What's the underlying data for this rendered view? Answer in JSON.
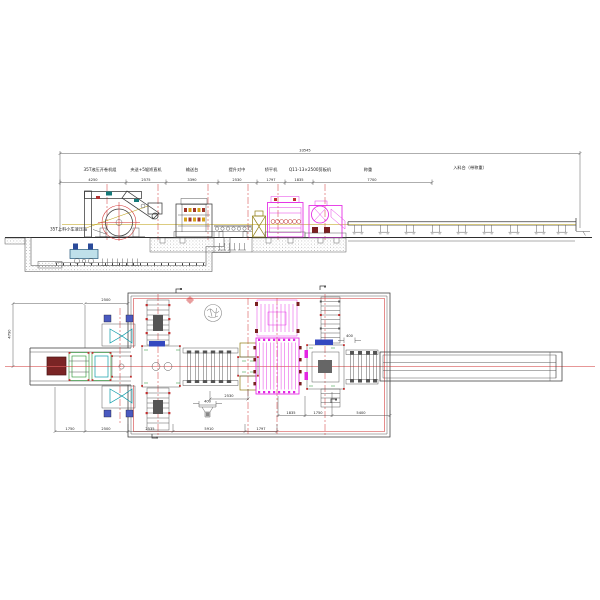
{
  "drawing": {
    "colors": {
      "line": "#3a3a3a",
      "centerline": "#d03030",
      "magenta_equipment": "#e326e3",
      "cyan_equipment": "#0a9aa8",
      "green_equipment": "#1f8f2a",
      "olive_equipment": "#8f7d12",
      "coil_fill": "#7a2525",
      "pass_line": "#b89a00"
    }
  },
  "elevation": {
    "total_dim": "33545",
    "machine_labels": [
      "35T液压开卷机组",
      "夹送+5辊矫直机",
      "输送台",
      "提升对中",
      "矫平机",
      "Q11-13×2500剪板机",
      "称重",
      "入料台（带称重）"
    ],
    "dims": [
      "4250",
      "2575",
      "3390",
      "2530",
      "1797",
      "1835",
      "7700"
    ],
    "pit_label": "35T上料小车液压站"
  },
  "plan": {
    "dim_track": "2500",
    "dim_width": "4790",
    "dim_mid": "2530",
    "dim_drain": "400",
    "dim_roller": "400",
    "dims_inner": [
      "1835",
      "1750",
      "5400"
    ],
    "dims_bottom": [
      "1750",
      "2500",
      "2535",
      "5910",
      "1797"
    ]
  }
}
